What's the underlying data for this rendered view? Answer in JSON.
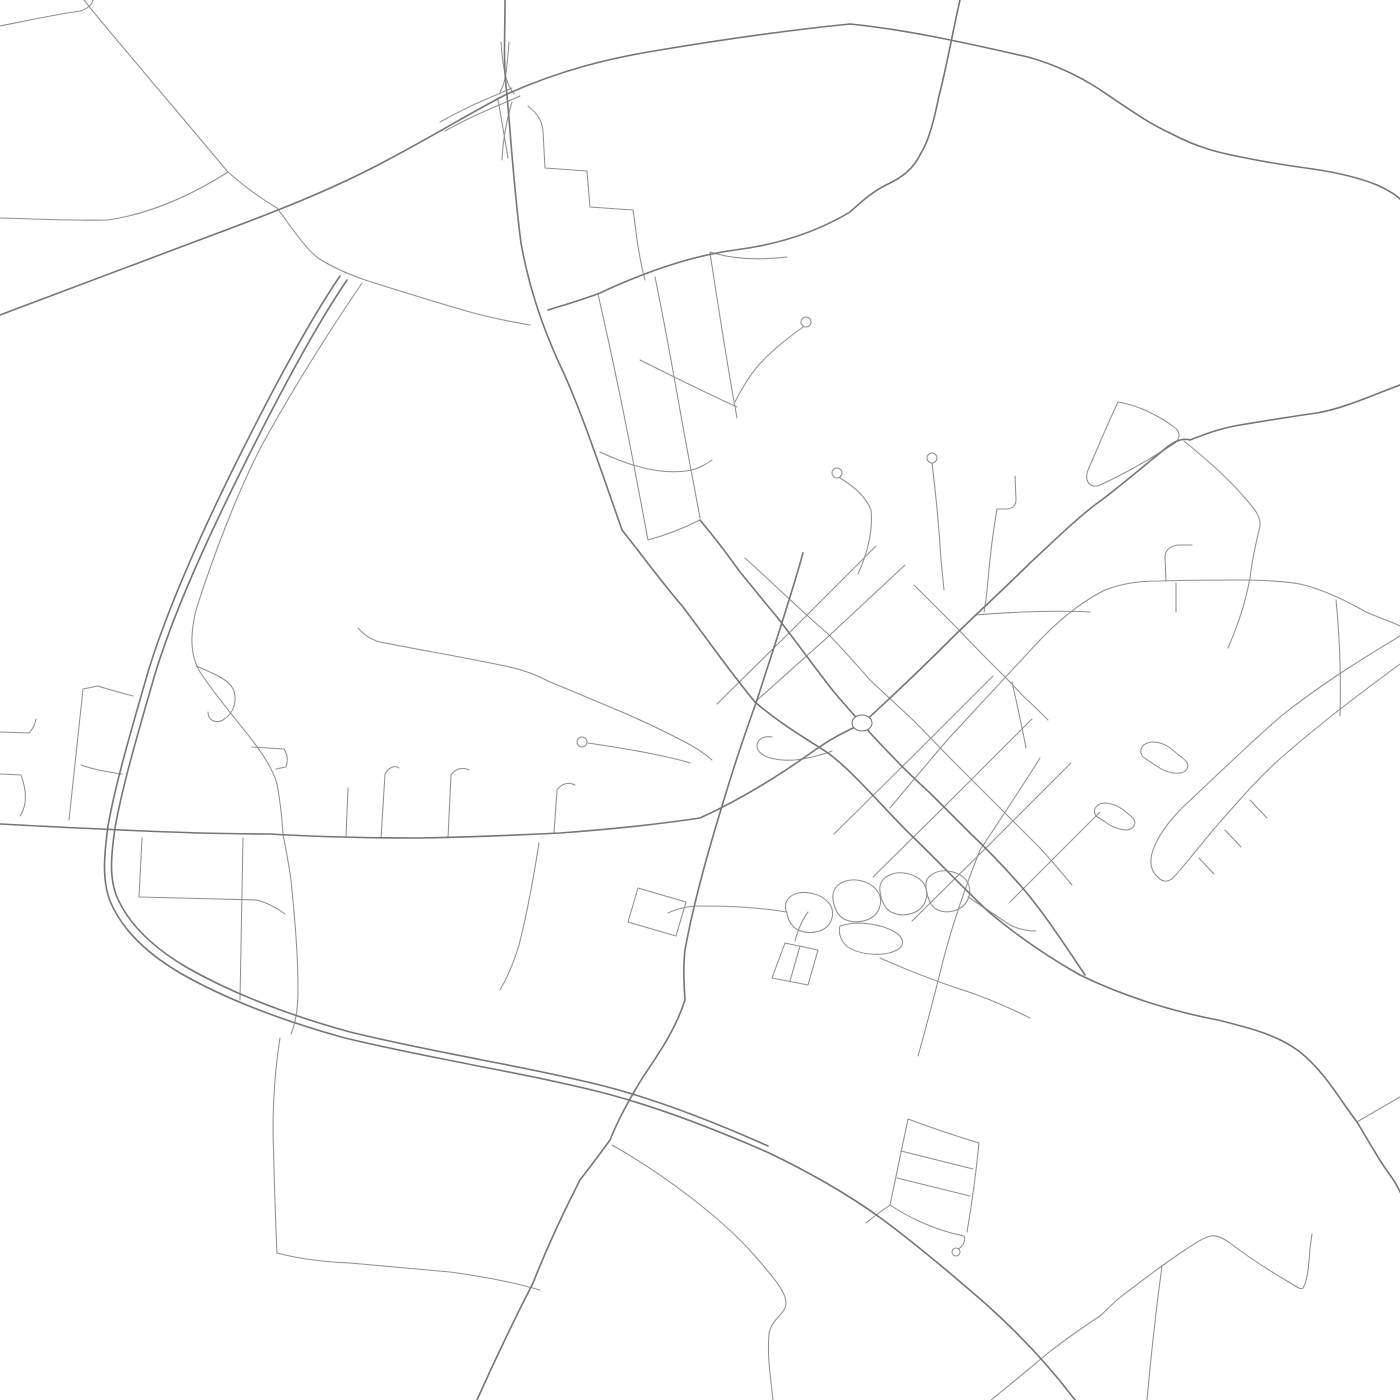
{
  "map": {
    "kind": "street-network-render",
    "background": "#ffffff",
    "stroke_major": "#757575",
    "stroke_minor": "#909090",
    "major_width": 1.6,
    "minor_width": 1.05,
    "viewbox": "0 0 1400 1400",
    "roundabout": {
      "cx": 862,
      "cy": 723,
      "rx": 10,
      "ry": 8
    },
    "roads_major": [
      {
        "name": "highway-ns",
        "d": "M505,0 C505,35 503,65 507,95 C511,140 514,190 521,243 C529,288 543,328 559,363 C577,400 597,458 622,530"
      },
      {
        "name": "artery-se",
        "d": "M622,530 C642,555 660,580 683,607 C705,636 730,672 755,702 C778,722 800,735 828,753 C855,773 885,810 913,837 C940,863 965,890 990,913 C1020,938 1050,958 1080,975 C1125,997 1175,1012 1218,1020 C1250,1028 1278,1035 1300,1052 C1325,1072 1340,1100 1357,1122 C1368,1140 1380,1162 1390,1175 C1395,1182 1398,1187 1400,1192"
      },
      {
        "name": "ew-highway",
        "d": "M0,315 C60,293 140,262 210,236 C280,210 330,190 378,165 C430,138 470,113 505,95 C560,70 610,58 660,50 C720,40 790,30 850,24 C910,30 975,45 1028,57 C1060,66 1082,78 1099,89 C1130,110 1150,124 1170,133 C1198,148 1220,153 1241,157 C1270,163 1290,166 1313,169 C1340,173 1360,178 1377,185 C1388,190 1395,194 1400,199"
      },
      {
        "name": "bypass-arc",
        "d": "M340,276 C310,320 275,385 240,455 C210,515 170,600 148,672 C136,714 116,780 108,826 C104,856 102,880 110,901 C122,930 148,954 180,973 C222,997 276,1019 345,1038 C408,1053 450,1060 478,1066 C520,1074 560,1082 600,1092 C655,1106 710,1127 767,1152 C805,1170 848,1194 882,1219 C917,1245 955,1277 987,1305 C1017,1332 1048,1364 1075,1400"
      },
      {
        "name": "bypass-arc-twin",
        "d": "M347,280 C317,324 282,389 247,459 C217,519 177,602 155,674 C143,716 123,782 115,828 C111,856 109,878 117,897 C129,925 154,948 186,967 C228,991 281,1013 350,1032 C412,1047 454,1054 482,1060 C524,1068 564,1076 604,1086 C658,1100 712,1121 768,1146"
      },
      {
        "name": "west-east-road-ne-artery",
        "d": "M0,824 C40,826 70,828 101,829 C160,832 220,834 270,834 C320,837 370,838 420,838 C470,837 520,835 560,833 C615,829 660,824 700,818 C740,800 780,775 815,750 C835,736 850,729 862,724 C885,703 920,670 950,640 C975,615 1003,590 1030,563 C1055,540 1080,515 1103,499 C1125,482 1145,465 1160,453 C1170,444 1180,437 1190,440 C1210,432 1223,428 1240,425 C1270,420 1295,416 1317,413 C1345,408 1370,396 1400,385"
      },
      {
        "name": "main-st-roundabout",
        "d": "M700,520 C715,538 728,555 740,572 C755,590 765,603 777,617 C795,640 815,668 834,692 C845,705 855,716 862,724 C872,735 882,746 893,757 C905,770 917,781 930,793 C943,806 957,820 970,833 C988,850 1005,868 1020,885 C1042,910 1065,945 1085,975"
      },
      {
        "name": "north-curve-road",
        "d": "M960,0 C952,35 946,70 939,96 C933,125 928,142 921,153 C913,170 901,178 886,185 C872,192 861,202 850,212 C815,233 775,245 735,250 C690,256 645,272 600,293 C582,300 564,305 548,310"
      },
      {
        "name": "south-west-road",
        "d": "M803,553 C790,600 773,650 757,700 C747,728 738,754 730,780 C712,838 695,895 685,950 C683,968 684,985 685,1000 C676,1028 660,1052 643,1077 C630,1098 618,1120 610,1140 C600,1154 590,1167 580,1180 C562,1215 546,1250 533,1283 C513,1322 494,1362 477,1400"
      }
    ],
    "roads_minor": [
      {
        "name": "nw-corner-stub",
        "d": "M0,26 C30,20 58,14 80,11 C87,9 92,5 93,0"
      },
      {
        "name": "left-horizontal",
        "d": "M0,218 C40,219 75,221 108,220 C155,213 195,193 228,172"
      },
      {
        "name": "topleft-diagonal",
        "d": "M84,0 C106,28 130,55 152,82 C178,112 205,145 228,172"
      },
      {
        "name": "wavy-mid",
        "d": "M228,172 C245,187 260,198 277,208 C292,228 305,248 318,258 C332,267 348,274 365,280 C400,291 435,302 470,312 C492,318 512,322 530,325"
      },
      {
        "name": "ssw-line",
        "d": "M362,283 C330,330 295,385 262,445 C240,487 215,550 196,610 C190,635 190,655 200,672 C215,695 235,718 252,740 C265,757 273,770 277,784 C280,800 282,818 283,834 C286,850 289,865 291,880 C295,920 298,955 298,990 C298,1008 296,1022 291,1034"
      },
      {
        "name": "p-loop",
        "d": "M196,666 C215,674 230,680 234,691 C237,702 234,713 223,720 C215,724 208,720 208,712"
      },
      {
        "name": "hook-b",
        "d": "M252,747 L284,749 C288,755 288,761 286,767 L276,769"
      },
      {
        "name": "left-block-west",
        "d": "M98,686 L83,689 C78,735 73,780 69,820"
      },
      {
        "name": "left-block-top",
        "d": "M98,686 C110,690 122,693 133,696"
      },
      {
        "name": "left-block-mid",
        "d": "M81,765 C95,770 108,772 122,774"
      },
      {
        "name": "left-stub-1",
        "d": "M0,732 L29,733 C33,729 35,724 36,719"
      },
      {
        "name": "left-stub-2",
        "d": "M0,774 L21,775 C25,786 26,796 25,803 C24,809 22,813 20,816"
      },
      {
        "name": "stub-348",
        "d": "M348,788 L346,837"
      },
      {
        "name": "stub-387",
        "d": "M385,774 L381,838"
      },
      {
        "name": "stub-387-hook",
        "d": "M385,774 C389,767 395,765 399,768"
      },
      {
        "name": "stub-450",
        "d": "M451,775 L448,838"
      },
      {
        "name": "stub-450-hook",
        "d": "M451,775 C456,768 463,767 469,770"
      },
      {
        "name": "stub-556",
        "d": "M557,790 L554,833"
      },
      {
        "name": "stub-556-hook",
        "d": "M557,790 C562,783 569,782 575,785"
      },
      {
        "name": "below-142",
        "d": "M142,838 L139,897"
      },
      {
        "name": "below-crossbar",
        "d": "M139,897 C170,898 225,899 257,900 C268,903 277,908 285,914"
      },
      {
        "name": "below-243",
        "d": "M243,838 C242,890 241,945 240,1000"
      },
      {
        "name": "below-539",
        "d": "M539,843 C534,875 528,910 519,945 C514,962 507,978 500,990"
      },
      {
        "name": "arc-branch-south",
        "d": "M280,1038 C275,1070 273,1100 273,1131 C274,1172 275,1212 277,1253 C300,1259 325,1262 350,1263 C383,1266 417,1269 450,1272 C480,1276 512,1282 540,1290"
      },
      {
        "name": "bottom-curve",
        "d": "M612,1145 C660,1172 720,1216 755,1256 C772,1276 786,1291 786,1303 C786,1314 771,1319 769,1334 C767,1358 771,1380 773,1400"
      },
      {
        "name": "wavy-1",
        "d": "M358,628 C365,636 372,640 380,642 C420,650 462,657 500,665 C518,668 535,674 550,682 C575,692 600,703 622,712 C645,722 668,733 685,742 C695,747 705,754 712,760"
      },
      {
        "name": "wavy-2",
        "d": "M588,743 C608,746 628,749 648,753 C663,756 678,759 690,763"
      },
      {
        "name": "scarf-block",
        "d": "M638,888 L686,902 L676,936 L628,922 Z"
      },
      {
        "name": "flag-2",
        "d": "M785,943 L818,950 L808,985 L772,978 Z"
      },
      {
        "name": "flag-2-mid",
        "d": "M800,946 L790,981"
      },
      {
        "name": "flag-2-stem",
        "d": "M795,941 C798,930 802,920 808,912"
      },
      {
        "name": "blob-west-link",
        "d": "M786,912 C770,909 755,908 740,907 C725,906 710,906 700,906 C688,906 676,909 668,913"
      },
      {
        "name": "blob-1",
        "d": "M787,913 C781,900 793,890 810,893 C826,896 835,906 832,918 C829,931 812,936 798,930 C791,926 788,920 787,913 Z"
      },
      {
        "name": "blob-2",
        "d": "M833,899 C831,885 846,877 862,881 C877,885 884,897 879,909 C874,921 856,925 844,919 C837,915 834,907 833,899 Z"
      },
      {
        "name": "blob-3",
        "d": "M880,891 C878,877 894,870 909,874 C924,878 930,890 925,902 C920,914 903,918 891,912 C884,908 881,899 880,891 Z"
      },
      {
        "name": "blob-4",
        "d": "M926,887 C924,875 939,868 953,872 C967,876 973,887 968,899 C963,911 947,915 936,909 C929,905 927,895 926,887 Z"
      },
      {
        "name": "blob-5",
        "d": "M840,926 C855,921 874,923 889,929 C903,935 907,944 897,950 C884,957 860,955 848,947 C841,942 838,933 840,926 Z"
      },
      {
        "name": "blob-tail",
        "d": "M968,897 C985,908 998,917 1010,925 C1020,930 1028,931 1036,931"
      },
      {
        "name": "ssw-line-2",
        "d": "M1040,758 C1020,790 1000,820 980,850 C965,888 952,925 942,965 C934,997 926,1028 918,1056"
      },
      {
        "name": "blob-se-curve",
        "d": "M880,958 C912,972 938,982 963,990 C987,998 1010,1008 1030,1018"
      },
      {
        "name": "cross-st-nw2",
        "d": "M876,546 L790,632 L717,704"
      },
      {
        "name": "cross-st-nw1",
        "d": "M905,565 L830,635 L755,702"
      },
      {
        "name": "cross-st-se1",
        "d": "M993,676 L915,754 L834,834"
      },
      {
        "name": "cross-st-se2",
        "d": "M1032,719 L953,798 L873,877"
      },
      {
        "name": "cross-st-se3",
        "d": "M1071,763 L992,842 L912,921"
      },
      {
        "name": "cross-st-se4",
        "d": "M1100,812 L1010,902"
      },
      {
        "name": "north-street",
        "d": "M745,558 C775,585 800,610 827,633 C842,648 856,664 870,680 C884,693 899,707 913,720 C927,734 941,749 955,763 C969,777 983,791 997,805 C1011,819 1026,834 1040,848 C1051,860 1062,873 1072,885"
      },
      {
        "name": "north-street-2",
        "d": "M914,585 C928,599 943,614 957,628 C971,643 986,658 1000,672 C1008,680 1015,687 1022,695 C1031,703 1040,712 1048,720"
      },
      {
        "name": "connector-east",
        "d": "M975,615 C1013,612 1051,610 1090,612"
      },
      {
        "name": "connector-short",
        "d": "M1012,682 C1017,704 1022,726 1026,748"
      },
      {
        "name": "parkway",
        "d": "M890,808 C910,784 930,760 950,737 C975,710 1005,678 1040,640 C1062,617 1083,601 1105,590 C1123,583 1140,581 1160,581 C1187,580 1214,580 1240,580 C1262,580 1282,581 1300,584 C1322,589 1345,600 1366,612 C1380,618 1392,622 1400,626"
      },
      {
        "name": "j-stub",
        "d": "M1166,581 L1165,558 C1165,550 1170,546 1178,545 L1192,545"
      },
      {
        "name": "stub-1176",
        "d": "M1176,583 L1176,612"
      },
      {
        "name": "triangle-se-line",
        "d": "M1184,441 C1205,458 1228,478 1244,497 C1255,509 1261,517 1260,526 C1256,543 1252,560 1250,578 C1246,600 1238,625 1228,648"
      },
      {
        "name": "triangle-loop",
        "d": "M1118,402 C1107,425 1096,452 1088,470 C1084,481 1090,489 1100,485 C1124,474 1152,458 1175,443 C1181,438 1180,431 1174,427 C1158,415 1137,405 1118,402 Z"
      },
      {
        "name": "band-line-1",
        "d": "M1400,636 C1360,660 1320,685 1280,717 C1248,745 1215,777 1183,807 C1168,822 1158,836 1153,850 C1149,862 1151,872 1158,877"
      },
      {
        "name": "band-line-2",
        "d": "M1400,664 C1362,692 1322,722 1282,757 C1258,778 1235,805 1214,829 C1198,848 1184,866 1174,877 C1168,883 1162,882 1158,877"
      },
      {
        "name": "band-tooth-1",
        "d": "M1250,800 L1267,818"
      },
      {
        "name": "band-tooth-2",
        "d": "M1225,830 L1241,847"
      },
      {
        "name": "band-tooth-3",
        "d": "M1199,858 L1214,874"
      },
      {
        "name": "church-key-1",
        "d": "M1143,757 C1138,750 1142,743 1152,742 C1158,742 1165,744 1170,748 L1185,760 C1190,765 1188,772 1180,773 C1172,774 1164,771 1158,767 Z"
      },
      {
        "name": "church-key-2",
        "d": "M1096,816 C1092,810 1096,804 1104,803 C1112,803 1120,807 1126,812 L1133,818 C1137,823 1134,829 1127,830 C1119,830 1110,826 1104,821 Z"
      },
      {
        "name": "vert-1340",
        "d": "M1336,600 C1340,640 1341,680 1340,716"
      },
      {
        "name": "zigzag-se",
        "d": "M991,1400 C1010,1385 1030,1368 1048,1353 C1065,1340 1083,1327 1100,1316 L1118,1299 C1140,1282 1165,1263 1185,1250 C1195,1243 1205,1237 1211,1236 C1217,1235 1223,1238 1230,1243 C1252,1260 1275,1274 1292,1284 C1297,1287 1301,1290 1303,1288 C1308,1280 1309,1262 1310,1248 L1312,1234"
      },
      {
        "name": "zigzag-branch",
        "d": "M1162,1266 C1156,1310 1151,1355 1147,1400"
      },
      {
        "name": "artery-ne-branch",
        "d": "M1357,1122 C1372,1113 1386,1105 1400,1097"
      },
      {
        "name": "ladder-top",
        "d": "M908,1119 C932,1128 956,1136 979,1143"
      },
      {
        "name": "ladder-right",
        "d": "M979,1143 C976,1173 972,1203 967,1232"
      },
      {
        "name": "ladder-left",
        "d": "M908,1119 C902,1148 896,1177 890,1205"
      },
      {
        "name": "ladder-bottom",
        "d": "M890,1205 C908,1217 930,1227 948,1232 C955,1234 960,1235 964,1236 C966,1240 963,1247 958,1249"
      },
      {
        "name": "ladder-rung-1",
        "d": "M901,1151 L973,1169"
      },
      {
        "name": "ladder-rung-2",
        "d": "M897,1178 L970,1196"
      },
      {
        "name": "ladder-link",
        "d": "M890,1205 C880,1212 872,1218 866,1223"
      },
      {
        "name": "rb-scarf",
        "d": "M772,737 C760,735 755,743 758,750 C763,758 778,761 795,760 C810,758 822,755 832,751"
      },
      {
        "name": "staircase",
        "d": "M528,106 C538,114 542,121 543,131 L545,168 L587,171 L590,207 L633,210 C635,222 636,234 638,246 C640,258 642,270 645,280"
      },
      {
        "name": "spur-252",
        "d": "M710,252 C735,260 762,260 787,257"
      },
      {
        "name": "minigrid-rail-1",
        "d": "M598,294 C608,338 617,380 625,420 C633,460 641,502 648,540"
      },
      {
        "name": "minigrid-rail-2",
        "d": "M655,277 C664,320 672,365 680,410 C687,450 694,485 700,518"
      },
      {
        "name": "minigrid-rail-3",
        "d": "M710,253 C717,298 724,344 732,390 L737,418"
      },
      {
        "name": "minigrid-crossbar-1",
        "d": "M640,360 C672,376 704,392 737,407"
      },
      {
        "name": "minigrid-crossbar-2",
        "d": "M600,452 C630,466 662,476 692,470 C700,468 706,464 712,460"
      },
      {
        "name": "minigrid-link",
        "d": "M648,540 C666,535 684,528 700,520"
      },
      {
        "name": "lollipop-1-stem",
        "d": "M803,327 C785,340 770,352 757,367 C748,378 741,390 735,402"
      },
      {
        "name": "lollipop-2-stem",
        "d": "M840,478 C855,487 866,497 871,510 C873,530 868,552 858,574"
      },
      {
        "name": "lollipop-3-stem",
        "d": "M932,463 C936,495 939,527 941,560 L944,590"
      },
      {
        "name": "hook-4",
        "d": "M1015,476 L1016,500 C1016,506 1012,509 1006,509 L997,509 C993,532 990,556 988,580 C987,591 986,602 984,612"
      },
      {
        "name": "interchange-lens-1",
        "d": "M440,122 C470,105 490,98 512,88"
      },
      {
        "name": "interchange-lens-2",
        "d": "M445,131 C475,114 498,106 520,96"
      },
      {
        "name": "interchange-spike-up-1",
        "d": "M501,42 C503,70 506,84 514,94"
      },
      {
        "name": "interchange-spike-up-2",
        "d": "M509,42 C507,68 506,82 500,92"
      },
      {
        "name": "interchange-spike-dn-1",
        "d": "M512,102 C506,122 503,140 502,160"
      },
      {
        "name": "interchange-spike-dn-2",
        "d": "M498,100 C502,122 505,140 508,158"
      }
    ],
    "circles": [
      {
        "name": "lollipop-1-head",
        "cx": 806,
        "cy": 322,
        "r": 5
      },
      {
        "name": "lollipop-2-head",
        "cx": 837,
        "cy": 473,
        "r": 5
      },
      {
        "name": "lollipop-3-head",
        "cx": 932,
        "cy": 458,
        "r": 5
      },
      {
        "name": "wavy-2-head",
        "cx": 582,
        "cy": 742,
        "r": 5
      },
      {
        "name": "ladder-tail-head",
        "cx": 956,
        "cy": 1252,
        "r": 4
      }
    ]
  }
}
